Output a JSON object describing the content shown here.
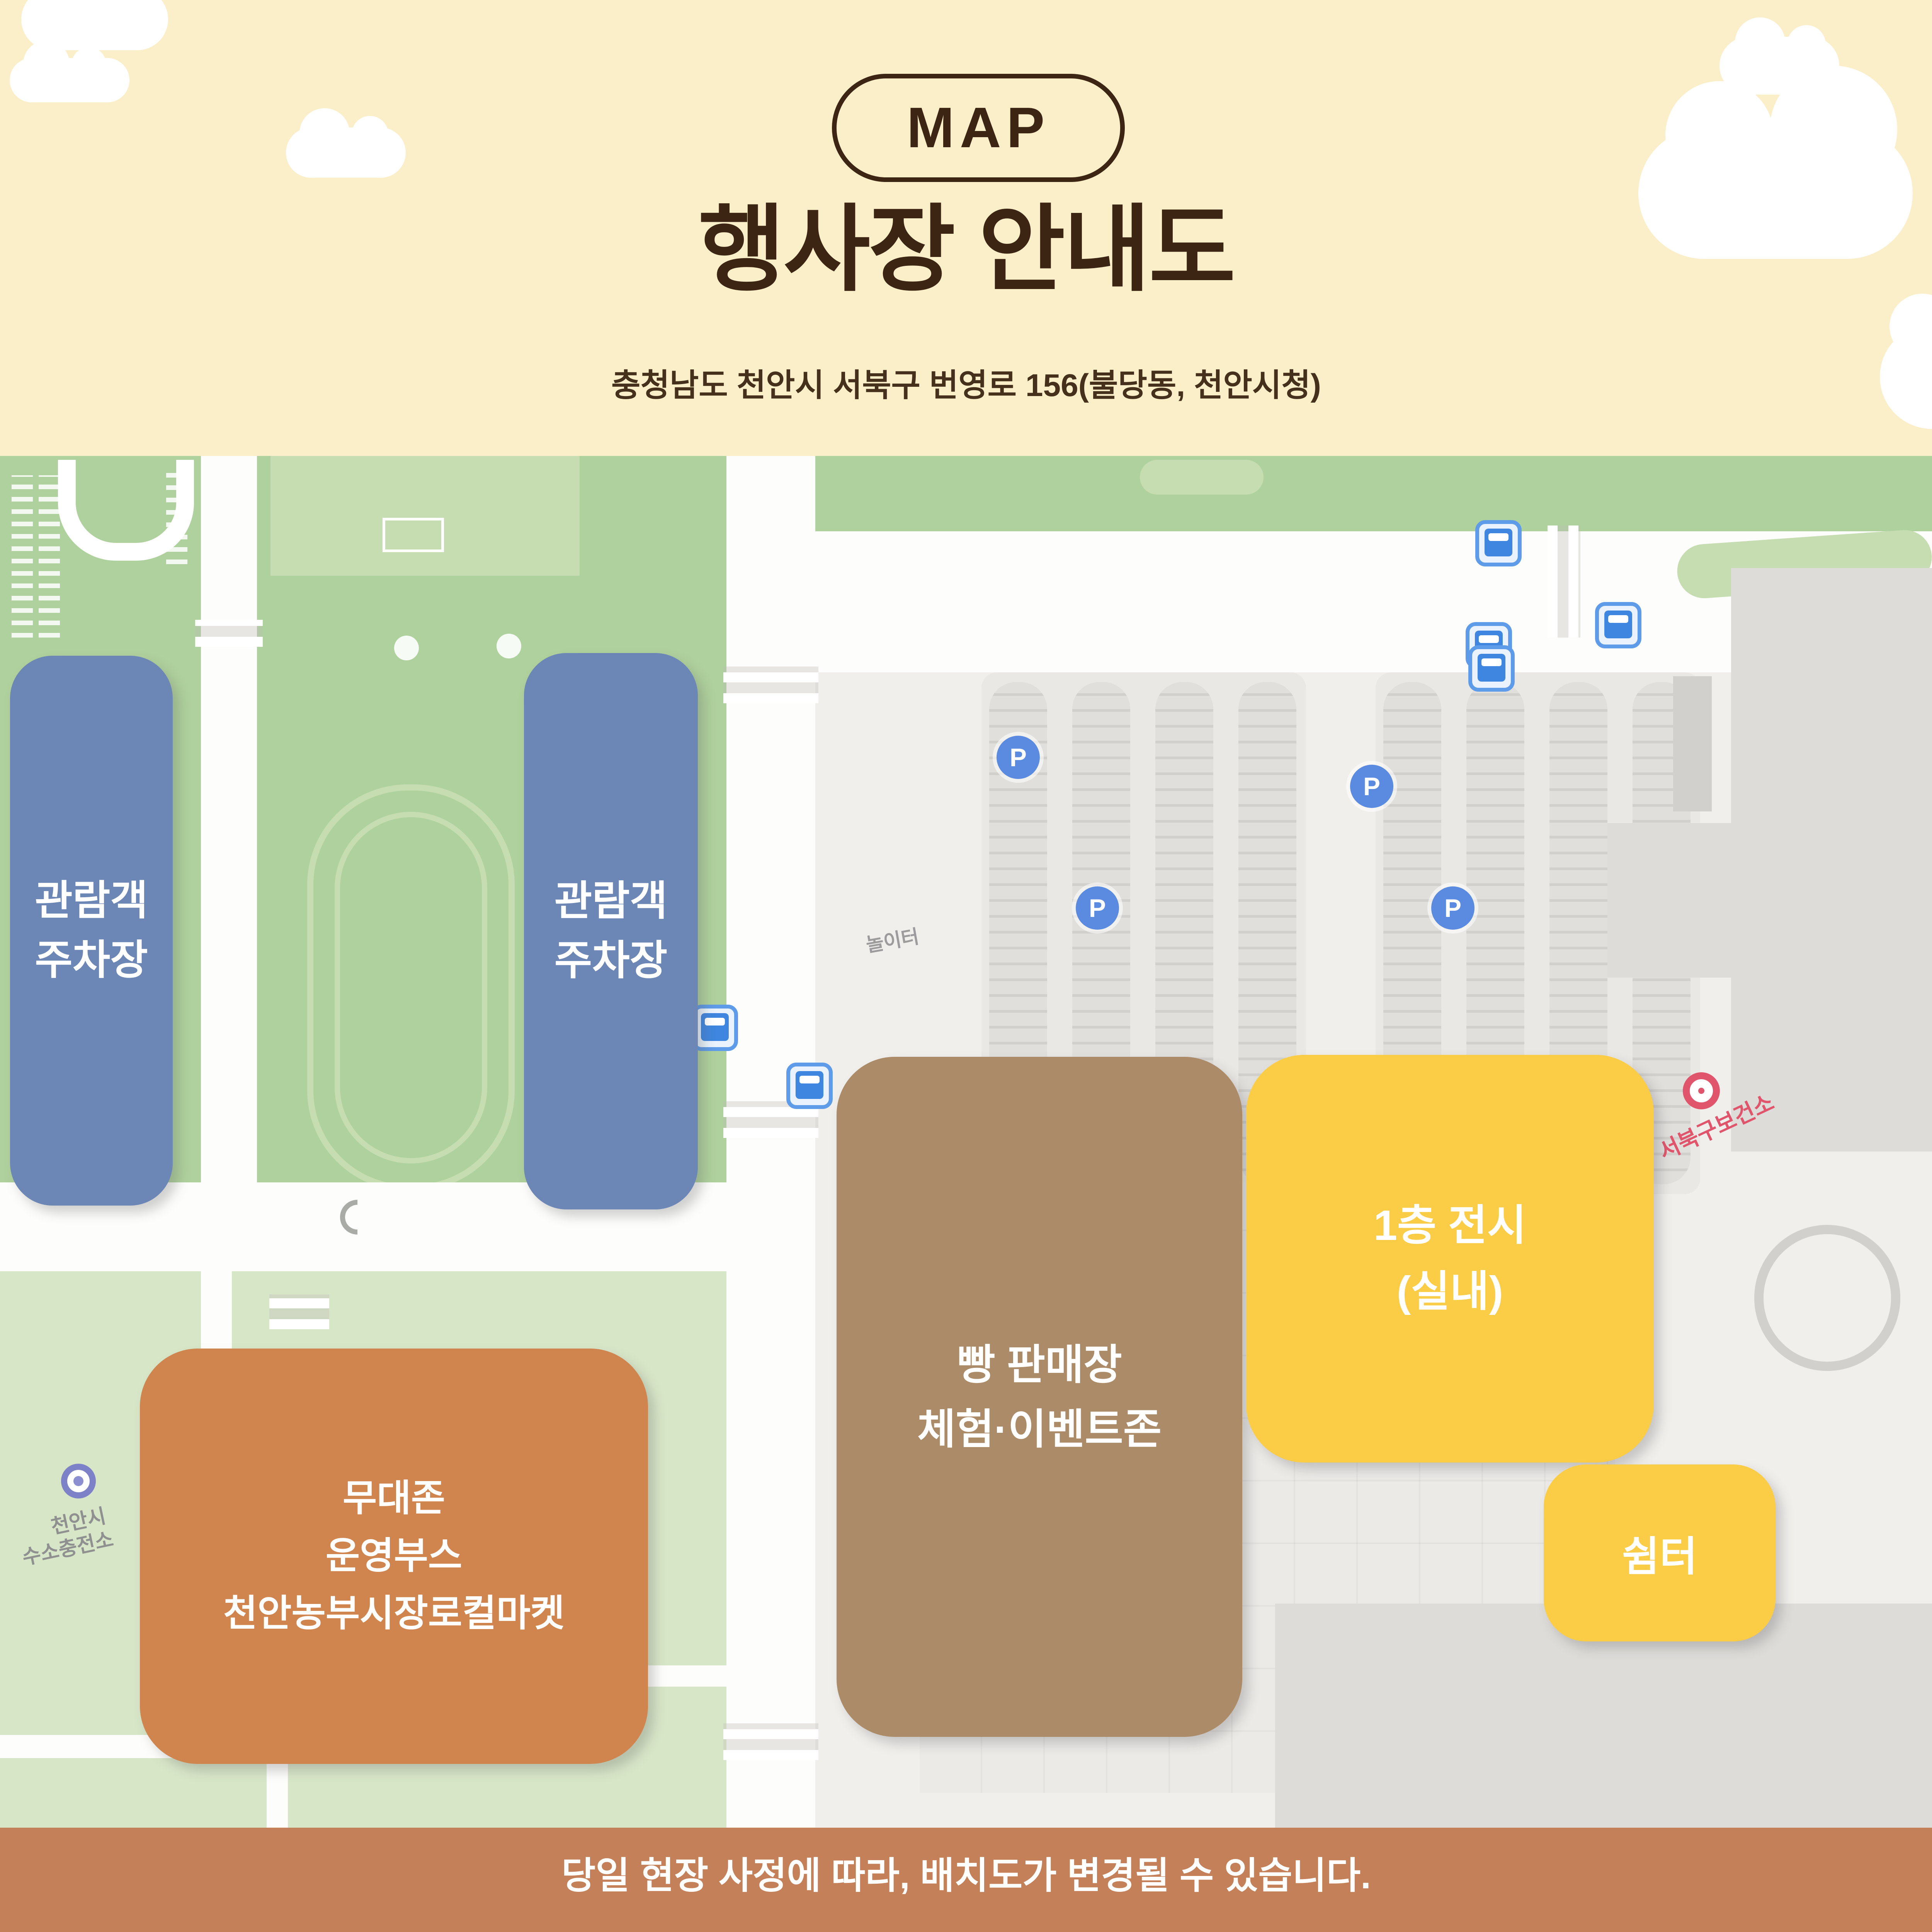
{
  "header": {
    "badge": "MAP",
    "title": "행사장 안내도",
    "address": "충청남도 천안시 서북구 번영로 156(불당동, 천안시청)"
  },
  "map": {
    "parking_badge": "P",
    "zones": [
      {
        "id": "visitor-parking-1",
        "label": "관람객\n주차장"
      },
      {
        "id": "visitor-parking-2",
        "label": "관람객\n주차장"
      },
      {
        "id": "stage-zone",
        "label": "무대존\n운영부스\n천안농부시장로컬마켓"
      },
      {
        "id": "bread-sale-zone",
        "label": "빵 판매장\n체험·이벤트존"
      },
      {
        "id": "exhibit-1f",
        "label": "1층 전시\n(실내)"
      },
      {
        "id": "shelter",
        "label": "쉼터"
      }
    ],
    "labels": {
      "playground": "놀이터",
      "health_center": "서북구보건소",
      "hydrogen_station_line1": "천안시",
      "hydrogen_station_line2": "수소충전소"
    }
  },
  "footer": {
    "notice": "당일 현장 사정에 따라, 배치도가 변경될 수 있습니다."
  },
  "colors": {
    "header_bg": "#FAEFC9",
    "ink": "#3C2513",
    "ink2": "#45301C",
    "map_base": "#F2F0ED",
    "green": "#AFD19D",
    "green_light": "#C5DDB1",
    "green_pale": "#D8E6C8",
    "road": "#FDFDFB",
    "campus": "#F1EFEC",
    "pad": "#EAE8E5",
    "bar": "#E1DFDC",
    "bar_line": "#D2D0CD",
    "bldg": "#DEDCD9",
    "bldg_light": "#ECEAE7",
    "blue": "#6C86B5",
    "brown": "#AC8B68",
    "yellow": "#FBCC46",
    "orange": "#D0854F",
    "footer_bg": "#C48058",
    "p_blue": "#5B8BE0",
    "red": "#E0556C"
  }
}
